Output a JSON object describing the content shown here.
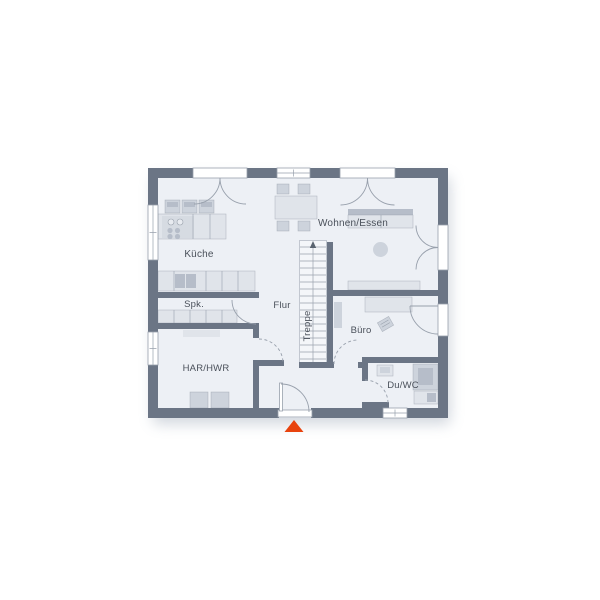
{
  "plan": {
    "rooms": [
      {
        "id": "kueche",
        "label": "Küche"
      },
      {
        "id": "spk",
        "label": "Spk."
      },
      {
        "id": "flur",
        "label": "Flur"
      },
      {
        "id": "treppe",
        "label": "Treppe"
      },
      {
        "id": "wohnen-essen",
        "label": "Wohnen/Essen"
      },
      {
        "id": "buero",
        "label": "Büro"
      },
      {
        "id": "har-hwr",
        "label": "HAR/HWR"
      },
      {
        "id": "du-wc",
        "label": "Du/WC"
      }
    ],
    "entrance_marker": {
      "icon": "triangle-up-icon"
    }
  },
  "colors": {
    "background": "#ffffff",
    "floor": "#edf0f5",
    "wall": "#6b7585",
    "outline": "#98a0ac",
    "furnLight": "#e0e4ea",
    "furnMed": "#cdd3dc",
    "furnDark": "#b6bdc9",
    "stair": "#f4f6f9",
    "text": "#4a505a",
    "marker": "#e8430e"
  }
}
